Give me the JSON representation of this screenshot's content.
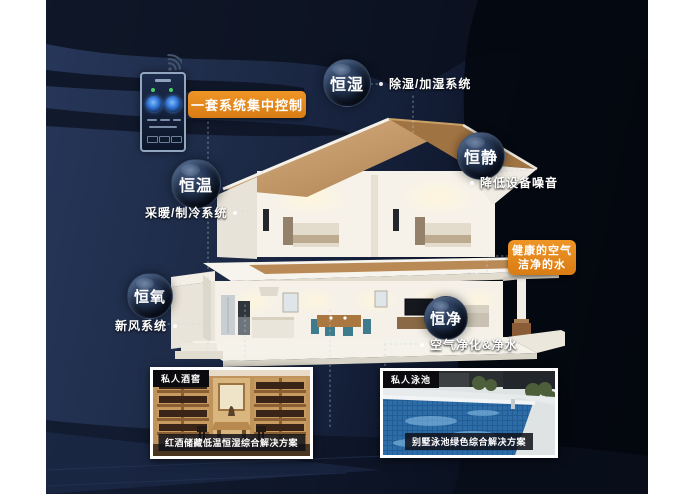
{
  "poster": {
    "background_navy": "#1e2c49",
    "accent_orange": "#e0861d"
  },
  "control_panel": {
    "badge": "一套系统集中控制"
  },
  "highlight": {
    "line1": "健康的空气",
    "line2": "洁净的水"
  },
  "bubbles": [
    {
      "label": "恒湿",
      "note": "除湿/加湿系统"
    },
    {
      "label": "恒静",
      "note": "降低设备噪音"
    },
    {
      "label": "恒温",
      "note": "采暖/制冷系统"
    },
    {
      "label": "恒氧",
      "note": "新风系统"
    },
    {
      "label": "恒净",
      "note": "空气净化&净水"
    }
  ],
  "cards": [
    {
      "tag": "私人酒窖",
      "caption": "红酒储藏低温恒湿综合解决方案"
    },
    {
      "tag": "私人泳池",
      "caption": "别墅泳池绿色综合解决方案"
    }
  ]
}
